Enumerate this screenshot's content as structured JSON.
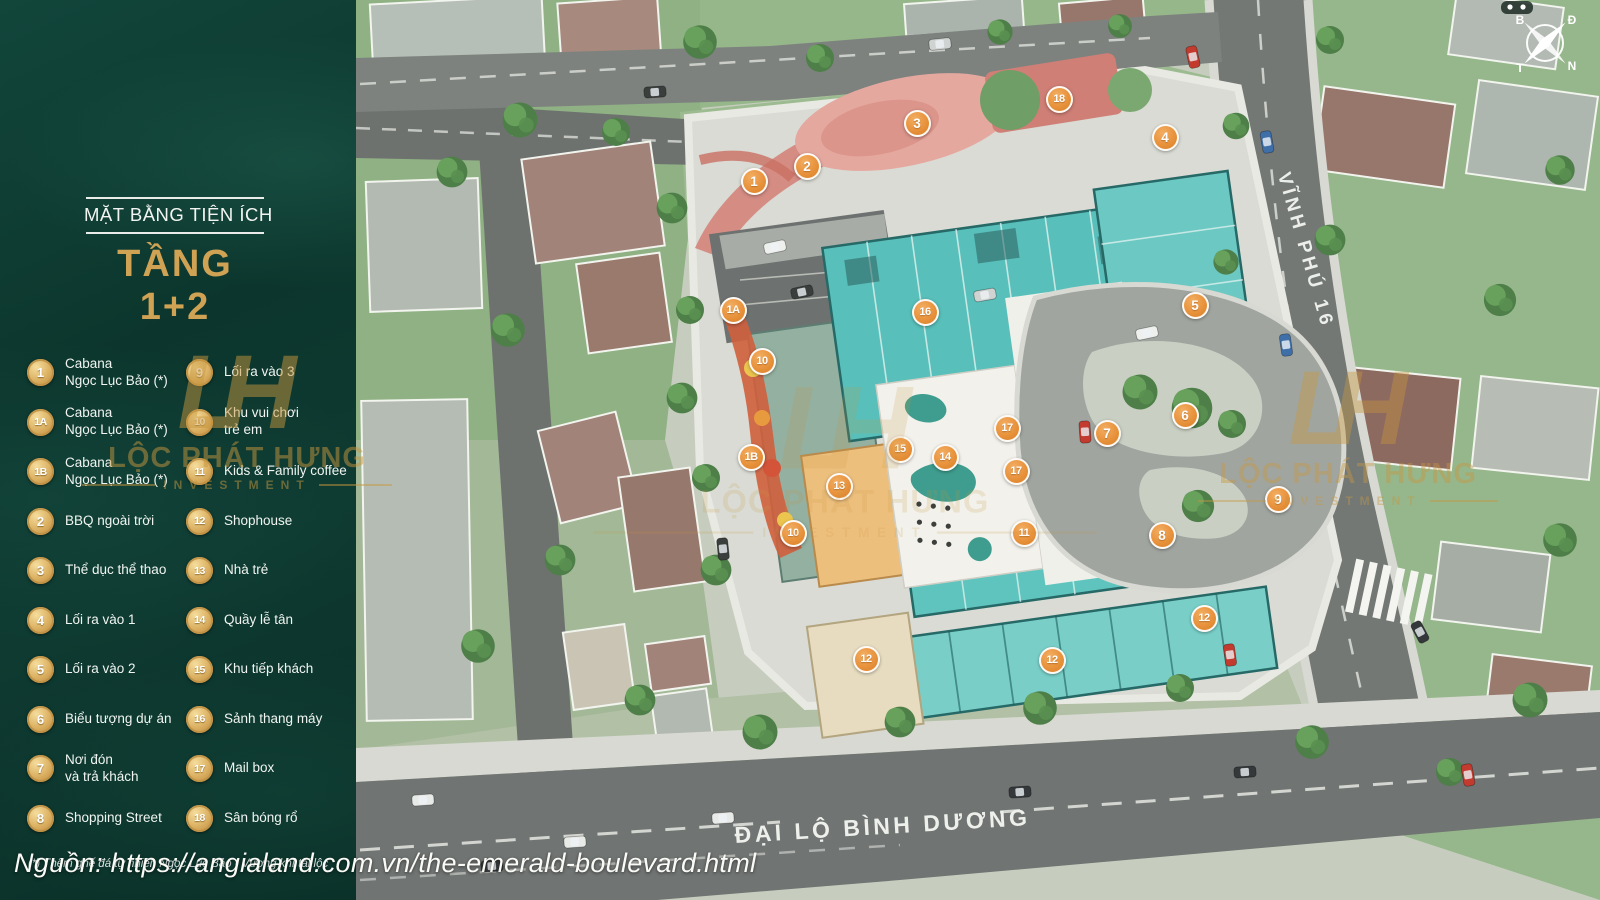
{
  "sidebar": {
    "title_small": "MẶT BẰNG TIỆN ÍCH",
    "title_large": "TẦNG 1+2",
    "footnote": "(*) Thêm ghế đá tự nhiên Ngọc Lục Bảo - Vượng khí tài lộc",
    "legend_left": [
      {
        "id": "1",
        "label": "Cabana\nNgọc Lục Bảo (*)"
      },
      {
        "id": "1A",
        "label": "Cabana\nNgọc Lục Bảo (*)"
      },
      {
        "id": "1B",
        "label": "Cabana\nNgọc Lục Bảo (*)"
      },
      {
        "id": "2",
        "label": "BBQ ngoài trời"
      },
      {
        "id": "3",
        "label": "Thể dục thể thao"
      },
      {
        "id": "4",
        "label": "Lối ra vào 1"
      },
      {
        "id": "5",
        "label": "Lối ra vào 2"
      },
      {
        "id": "6",
        "label": "Biểu tượng dự án"
      },
      {
        "id": "7",
        "label": "Nơi đón\nvà trả khách"
      },
      {
        "id": "8",
        "label": "Shopping Street"
      }
    ],
    "legend_right": [
      {
        "id": "9",
        "label": "Lối ra vào 3"
      },
      {
        "id": "10",
        "label": "Khu vui chơi\ntrẻ em"
      },
      {
        "id": "11",
        "label": "Kids & Family coffee"
      },
      {
        "id": "12",
        "label": "Shophouse"
      },
      {
        "id": "13",
        "label": "Nhà trẻ"
      },
      {
        "id": "14",
        "label": "Quầy lễ tân"
      },
      {
        "id": "15",
        "label": "Khu tiếp khách"
      },
      {
        "id": "16",
        "label": "Sảnh thang máy"
      },
      {
        "id": "17",
        "label": "Mail box"
      },
      {
        "id": "18",
        "label": "Sân bóng rổ"
      }
    ]
  },
  "map": {
    "road_labels": {
      "right": "VĨNH PHÚ 16",
      "bottom": "ĐẠI LỘ BÌNH DƯƠNG"
    },
    "compass": {
      "n": "B",
      "e": "Đ",
      "w": "T",
      "s": "N"
    },
    "watermark": {
      "monogram": "LH",
      "line1": "LỘC PHÁT HƯNG",
      "line2": "INVESTMENT"
    },
    "markers": [
      {
        "label": "1",
        "x": 754,
        "y": 181
      },
      {
        "label": "2",
        "x": 807,
        "y": 166
      },
      {
        "label": "3",
        "x": 917,
        "y": 123
      },
      {
        "label": "18",
        "x": 1059,
        "y": 99
      },
      {
        "label": "4",
        "x": 1165,
        "y": 137
      },
      {
        "label": "1A",
        "x": 733,
        "y": 310
      },
      {
        "label": "16",
        "x": 925,
        "y": 312
      },
      {
        "label": "5",
        "x": 1195,
        "y": 305
      },
      {
        "label": "10",
        "x": 762,
        "y": 361
      },
      {
        "label": "6",
        "x": 1185,
        "y": 415
      },
      {
        "label": "7",
        "x": 1107,
        "y": 433
      },
      {
        "label": "1B",
        "x": 751,
        "y": 457
      },
      {
        "label": "15",
        "x": 900,
        "y": 449
      },
      {
        "label": "14",
        "x": 945,
        "y": 457
      },
      {
        "label": "17",
        "x": 1007,
        "y": 428
      },
      {
        "label": "17",
        "x": 1016,
        "y": 471
      },
      {
        "label": "13",
        "x": 839,
        "y": 486
      },
      {
        "label": "9",
        "x": 1278,
        "y": 499
      },
      {
        "label": "10",
        "x": 793,
        "y": 533
      },
      {
        "label": "11",
        "x": 1024,
        "y": 533
      },
      {
        "label": "8",
        "x": 1162,
        "y": 535
      },
      {
        "label": "12",
        "x": 866,
        "y": 659
      },
      {
        "label": "12",
        "x": 1052,
        "y": 660
      },
      {
        "label": "12",
        "x": 1204,
        "y": 618
      }
    ]
  },
  "source_credit": "Nguồn: https://angialand.com.vn/the-emerald-boulevard.html",
  "colors": {
    "sidebar_green": "#0e3a31",
    "accent_gold": "#cfa254",
    "marker_orange": "#e8923c",
    "building_teal": "#58bfba",
    "watermark_gold": "#c8973f"
  }
}
